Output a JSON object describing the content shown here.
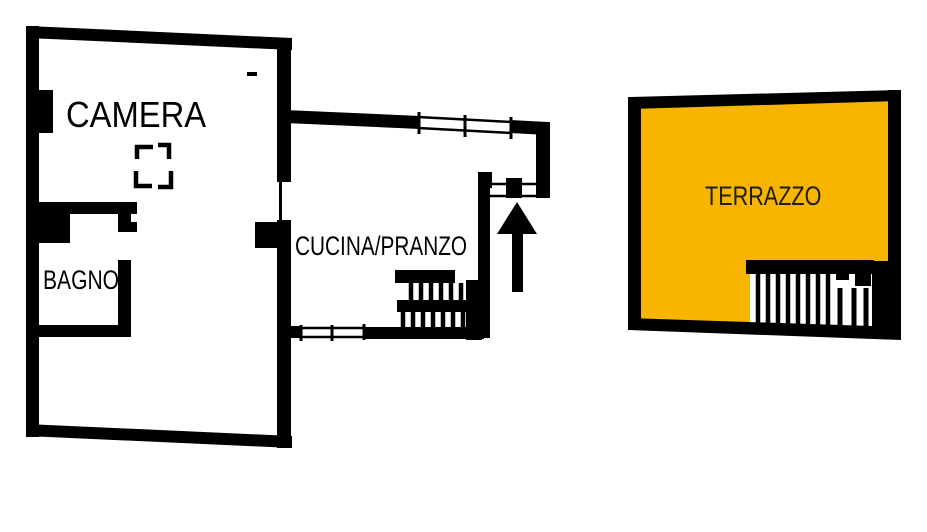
{
  "colors": {
    "background": "#ffffff",
    "walls": "#000000",
    "terrazzo_fill": "#F7B500",
    "terrazzo_label": "#1d1d1b"
  },
  "rooms": {
    "camera": {
      "label": "CAMERA"
    },
    "bagno": {
      "label": "BAGNO"
    },
    "cucina_pranzo": {
      "label": "CUCINA/PRANZO"
    },
    "terrazzo": {
      "label": "TERRAZZO"
    }
  },
  "icons": {
    "entrance_arrow": "up-arrow",
    "stairs_main": "hatched-stairs",
    "stairs_terrace": "hatched-stairs",
    "flue_symbol": "dashed-corner-box",
    "window_top": "double-line-window",
    "window_bottom": "double-line-window",
    "entrance_threshold": "door-threshold"
  }
}
